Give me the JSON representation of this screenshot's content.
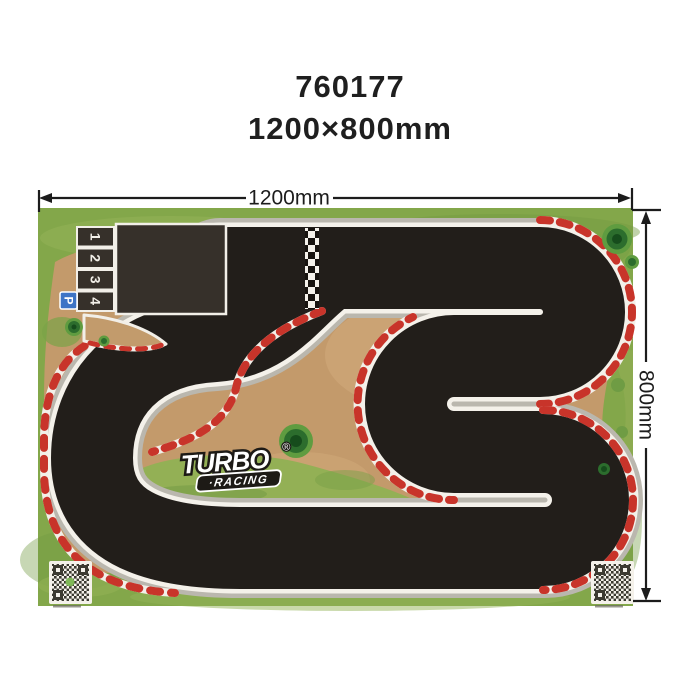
{
  "title": {
    "model_number": "760177",
    "size_label": "1200×800mm"
  },
  "dimensions": {
    "width_label": "1200mm",
    "height_label": "800mm"
  },
  "mat": {
    "start_grid_positions": [
      "1",
      "2",
      "3",
      "4"
    ],
    "parking_sign": "P",
    "logo": {
      "brand": "TURBO",
      "sub_brand": "·RACING",
      "registered_mark": "®"
    },
    "colors": {
      "grass_green": "#83a74a",
      "dirt_tan": "#c39a6b",
      "track_black": "#221e1a",
      "track_edge_white": "#f4f1ea",
      "apron_gray": "#bab7ae",
      "curb_red": "#c8342a",
      "parking_blue": "#3d74c6"
    }
  }
}
